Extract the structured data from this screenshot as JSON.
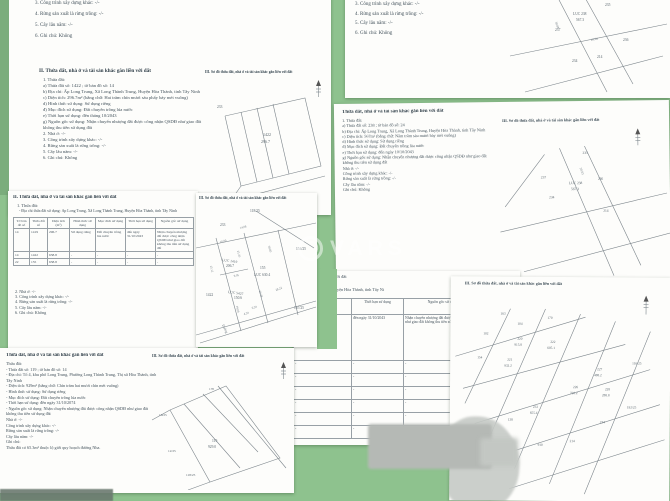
{
  "colors": {
    "background_green": "#8ec28e",
    "left_strip_green": "#7bad7c",
    "page_white": "#fdfdfb",
    "scan_text": "#41505a",
    "watermark_white": "rgba(255,255,255,0.5)"
  },
  "watermark": {
    "brand": "VARS"
  },
  "sketch_heading": "III. Sơ đồ thửa đất, nhà ở và tài sản khác gắn liền với đất",
  "pages": {
    "top_left": {
      "prev_tail": [
        "3. Công trình xây dựng khác: -/-",
        "4. Rừng sản xuất là rừng trồng: -/-",
        "5. Cây lâu năm: -/-",
        "6. Ghi chú: Không"
      ],
      "heading": "II. Thửa đất, nhà ở và tài sản khác gắn liền với đất",
      "lines": [
        "1. Thửa đất:",
        "a) Thửa đất số: 1422 ; tờ bản đồ số: 14",
        "b) Địa chỉ: Ấp Long Trung, Xã Long Thành Trung, Huyện Hòa Thành, tỉnh Tây Ninh",
        "c) Diện tích: 296.7m² (bằng chữ: Hai trăm chín mươi sáu phẩy bảy mét vuông)",
        "d) Hình thức sử dụng: Sử dụng riêng",
        "đ) Mục đích sử dụng: Đất chuyên trồng lúa nước",
        "e) Thời hạn sử dụng: đến tháng 10/2043",
        "g) Nguồn gốc sử dụng: Nhận chuyển nhượng đất được công nhận QSDĐ như giao đất",
        "không thu tiền sử dụng đất",
        "2. Nhà ở: -/-",
        "3. Công trình xây dựng khác: -/-",
        "4. Rừng sản xuất là rừng trồng: -/-",
        "5. Cây lâu năm: -/-",
        "6. Ghi chú: Không"
      ],
      "sketch": {
        "parcel": "1422",
        "area": "296.7",
        "neighbors": [
          "233",
          "1419",
          "155"
        ]
      }
    },
    "top_center": {
      "prev_tail": [
        "3. Công trình xây dựng khác: -/-",
        "4. Rừng sản xuất là rừng trồng: -/-",
        "5. Cây lâu năm: -/-",
        "6. Ghi chú: Không"
      ],
      "sketch": {
        "labels": [
          "235",
          "LUC 238",
          "567.3",
          "237",
          "236",
          "18.06",
          "214",
          "234",
          "38.88"
        ]
      }
    },
    "mid_right": {
      "heading": "Thửa đất, nhà ở và tài sản khác gắn liền với đất",
      "lines": [
        "1. Thửa đất:",
        "a) Thửa đất số: 238 ; tờ bản đồ số: 24",
        "b) Địa chỉ: Ấp Long Trung, Xã Long Thành Trung, Huyện Hòa Thành, tỉnh Tây Ninh",
        "c) Diện tích: 567m² (bằng chữ: Năm trăm sáu mươi bảy mét vuông)",
        "d) Hình thức sử dụng: Sử dụng riêng",
        "đ) Mục đích sử dụng: Đất chuyên trồng lúa nước",
        "e) Thời hạn sử dụng: đến ngày 10/10/2043",
        "g) Nguồn gốc sử dụng: Nhận chuyển nhượng đất được công nhận QSDĐ như giao đất",
        "không thu tiền sử dụng đất",
        "Nhà ở: -/-",
        "Công trình xây dựng khác: -/-",
        "Rừng sản xuất là rừng trồng: -/-",
        "Cây lâu năm: -/-",
        "Ghi chú: Không"
      ],
      "sketch": {
        "labels": [
          "235",
          "237",
          "LUC 238",
          "567.3",
          "236",
          "234",
          "214",
          "30.03"
        ]
      }
    },
    "mid_left": {
      "heading": "II. Thửa đất, nhà ở và tài sản khác gắn liền với đất",
      "sub": "1. Thửa đất:",
      "address": "- Địa chỉ thửa đất sử dụng: Ấp Long Trung, Xã Long Thành Trung, Huyện Hòa Thành, tỉnh Tây Ninh",
      "table": {
        "headers": [
          "Tờ bản đồ số",
          "Thửa đất số",
          "Diện tích (m²)",
          "Hình thức sử dụng",
          "Mục đích sử dụng",
          "Thời hạn sử dụng",
          "Nguồn gốc sử dụng"
        ],
        "rows": [
          [
            "14",
            "1419",
            "296.7",
            "Sử dụng riêng",
            "Đất chuyên trồng lúa nước",
            "đến ngày 31/10/2043",
            "Nhận chuyển nhượng đất được công nhận QSDĐ như giao đất không thu tiền sử dụng đất"
          ],
          [
            "14",
            "1422",
            "638.8",
            "-",
            "-",
            "-",
            "-"
          ],
          [
            "22",
            "155",
            "638.8",
            "-",
            "-",
            "-",
            "-"
          ]
        ]
      },
      "tail": [
        "2. Nhà ở: -/-",
        "3. Công trình xây dựng khác: -/-",
        "4. Rừng sản xuất là rừng trồng: -/-",
        "5. Cây lâu năm: -/-",
        "6. Ghi chú: Không"
      ]
    },
    "center_map": {
      "neighbors": [
        "118/25",
        "233",
        "154/25",
        "1422",
        "167/25"
      ],
      "p1": [
        "LUC 1419",
        "206.7"
      ],
      "p2": [
        "155",
        "LUC 630.4"
      ],
      "p3": [
        "LUC 5427",
        "150.6"
      ],
      "measures": [
        "14.08",
        "10.00",
        "21.35",
        "30.03",
        "25.12",
        "9.05",
        "26.38",
        "28.22",
        "19.00",
        "6.20",
        "4.20"
      ],
      "road": "Đường"
    },
    "bottom_left": {
      "heading": "Thửa đất, nhà ở và tài sản khác gắn liền với đất",
      "lines": [
        "Thửa đất:",
        "- Thửa đất số: 119 ; tờ bản đồ số: 14",
        "- Địa chỉ: Tổ 4, khu phố Long Trung, Phường Long Thành Trung, Thị xã Hòa Thành, tỉnh",
        "Tây Ninh",
        "- Diện tích: 929m² (bằng chữ: Chín trăm hai mươi chín mét vuông)",
        "- Hình thức sử dụng: Sử dụng riêng",
        "- Mục đích sử dụng: Đất chuyên trồng lúa nước",
        "- Thời hạn sử dụng: đến ngày 31/10/2074",
        "- Nguồn gốc sử dụng: Nhận chuyển nhượng đất được công nhận QSDĐ như giao đất",
        "không thu tiền sử dụng đất",
        "Nhà ở: -/-",
        "Công trình xây dựng khác: -/-",
        "Rừng sản xuất là rừng trồng: -/-",
        "Cây lâu năm: -/-",
        "Ghi chú:",
        "Thửa đất có 65.3m² thuộc lộ giới quy hoạch đường Nha."
      ],
      "sketch": {
        "labels": [
          "170",
          "16/25",
          "119",
          "929.0",
          "12/25",
          "118/25"
        ]
      }
    },
    "bottom_mid": {
      "fragment": "a với đất",
      "address": "g Thành Trung, Huyện Hòa Thành, tỉnh Tây Ni",
      "table": {
        "headers": [
          "Mục đích sử dụng",
          "Thời hạn sử dụng",
          "Nguồn gốc sử dụng"
        ],
        "row1": [
          "chuyên trồng lúa nước",
          "đến ngày 31/10/2043",
          "Nhận chuyển nhượng đất được công nhận QSDĐ như giao đất không thu tiền sử dụng đất"
        ],
        "empty_rows": [
          [
            "-",
            "-",
            "-"
          ],
          [
            "-",
            "-",
            "-"
          ],
          [
            "-",
            "-",
            "-"
          ],
          [
            "-",
            "-",
            "-"
          ],
          [
            "-",
            "-",
            "-"
          ],
          [
            "-",
            "-",
            "-"
          ]
        ]
      }
    },
    "bottom_right": {
      "top_labels": [
        "163",
        "104",
        "102",
        "170"
      ],
      "parcels": [
        [
          "220",
          "915.8"
        ],
        [
          "221",
          "932.2"
        ],
        [
          "222",
          "605.1"
        ],
        [
          "226",
          "728.2"
        ],
        [
          "227",
          "488.2"
        ],
        [
          "228",
          "288.8"
        ],
        [
          "233",
          "655.4"
        ]
      ],
      "edge_labels": [
        "116/25",
        "192/25",
        "154",
        "138",
        "234",
        "214",
        "910"
      ]
    }
  }
}
